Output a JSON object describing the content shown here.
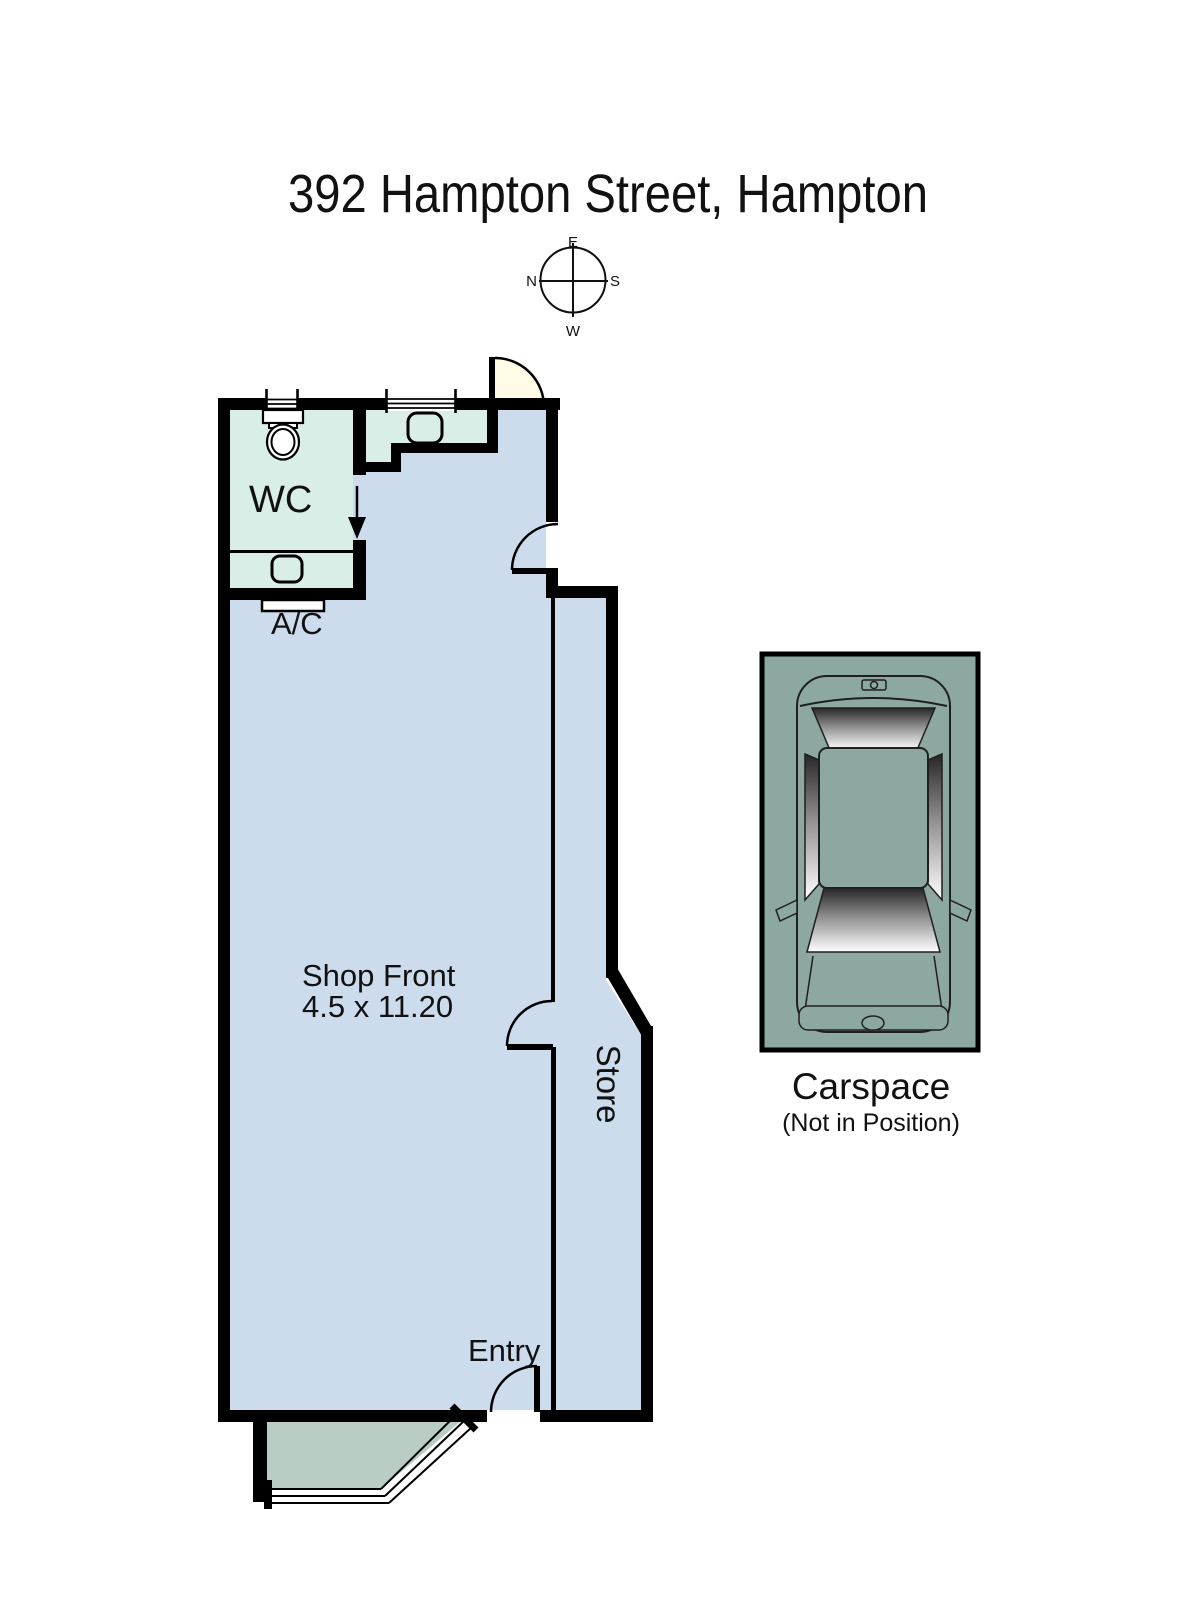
{
  "title": "392 Hampton Street, Hampton",
  "compass": {
    "top": "E",
    "left": "N",
    "right": "S",
    "bottom": "W"
  },
  "floorplan": {
    "wc_label": "WC",
    "ac_label": "A/C",
    "shop_front_label": "Shop Front",
    "shop_front_dimensions": "4.5 x 11.20",
    "store_label": "Store",
    "entry_label": "Entry"
  },
  "carspace": {
    "label": "Carspace",
    "note": "(Not in Position)"
  },
  "colors": {
    "shop_fill": "#cddcec",
    "wet_area_fill": "#d8eee6",
    "porch_fill": "#b9cdc5",
    "carspace_fill": "#8da7a1",
    "door_swing_fill": "#fffbe6",
    "wall": "#000000"
  }
}
